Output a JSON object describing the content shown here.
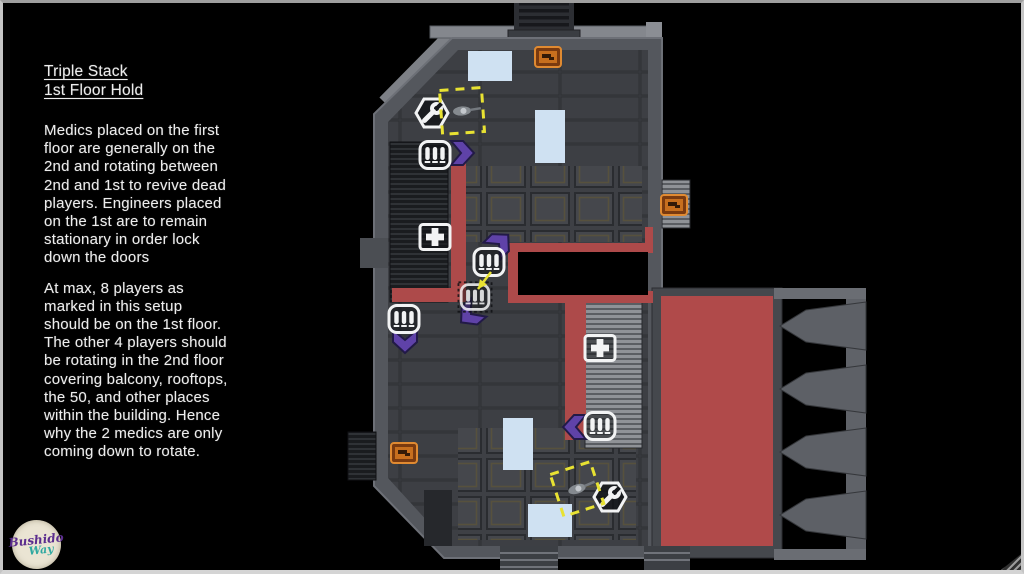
{
  "notes": {
    "title_line1": "Triple Stack",
    "title_line2": "1st Floor Hold",
    "paragraph1": "Medics placed on the first\nfloor are generally on the\n2nd and rotating between\n2nd and 1st to revive dead\nplayers. Engineers placed\non the 1st are to remain\nstationary in order lock\ndown the doors",
    "paragraph2": "At max, 8 players as\nmarked in this setup\nshould be on the 1st floor.\nThe other 4 players should\nbe rotating in the 2nd floor\ncovering balcony, rooftops,\nthe 50, and other places\nwithin the building. Hence\nwhy the 2 medics are only\ncoming down to rotate."
  },
  "logo": {
    "line1": "Bushido",
    "line2": "Way"
  },
  "map": {
    "colors": {
      "route": "#ad4a4a",
      "red_zone": "#b04a4a",
      "window": "#cfe1f2",
      "chevron": "#5f42a8",
      "marker": "#e8e232",
      "icon_stroke": "#f2f3f4",
      "crate_orange": "#c76f1e"
    },
    "kit_icons": [
      {
        "type": "engineer",
        "x": 432,
        "y": 113
      },
      {
        "type": "rifleman",
        "x": 435,
        "y": 155
      },
      {
        "type": "medic",
        "x": 435,
        "y": 237
      },
      {
        "type": "rifleman",
        "x": 489,
        "y": 262
      },
      {
        "type": "rifleman",
        "x": 475,
        "y": 297,
        "dimmed": true
      },
      {
        "type": "rifleman",
        "x": 404,
        "y": 319
      },
      {
        "type": "medic",
        "x": 600,
        "y": 348
      },
      {
        "type": "rifleman",
        "x": 600,
        "y": 426
      },
      {
        "type": "engineer",
        "x": 610,
        "y": 497
      }
    ],
    "chevrons": [
      {
        "x": 461,
        "y": 153,
        "dir": 0
      },
      {
        "x": 499,
        "y": 244,
        "dir": -45
      },
      {
        "x": 471,
        "y": 314,
        "dir": 140
      },
      {
        "x": 405,
        "y": 340,
        "dir": 90
      },
      {
        "x": 576,
        "y": 427,
        "dir": 180
      }
    ],
    "player_markers": [
      {
        "x": 462,
        "y": 111,
        "rot": -4
      },
      {
        "x": 577,
        "y": 489,
        "rot": -18
      }
    ],
    "ammo_crates": [
      {
        "x": 548,
        "y": 57
      },
      {
        "x": 674,
        "y": 205
      },
      {
        "x": 404,
        "y": 453
      }
    ],
    "windows": [
      {
        "x": 468,
        "y": 51,
        "w": 44,
        "h": 30
      },
      {
        "x": 535,
        "y": 110,
        "w": 30,
        "h": 53
      },
      {
        "x": 503,
        "y": 418,
        "w": 30,
        "h": 52
      },
      {
        "x": 528,
        "y": 504,
        "w": 44,
        "h": 33
      }
    ],
    "route_segments": [
      {
        "x": 451,
        "y": 163,
        "w": 15,
        "h": 139
      },
      {
        "x": 392,
        "y": 288,
        "w": 74,
        "h": 14
      },
      {
        "x": 508,
        "y": 243,
        "w": 145,
        "h": 10
      },
      {
        "x": 508,
        "y": 243,
        "w": 12,
        "h": 60
      },
      {
        "x": 520,
        "y": 291,
        "w": 133,
        "h": 12
      },
      {
        "x": 645,
        "y": 227,
        "w": 8,
        "h": 26
      },
      {
        "x": 565,
        "y": 295,
        "w": 21,
        "h": 145
      }
    ],
    "stairwell_opening": {
      "x": 518,
      "y": 252,
      "w": 130,
      "h": 43
    },
    "red_zone": {
      "x": 661,
      "y": 296,
      "w": 112,
      "h": 250
    },
    "rotation_arrow": {
      "x1": 491,
      "y1": 272,
      "x2": 478,
      "y2": 289
    }
  }
}
